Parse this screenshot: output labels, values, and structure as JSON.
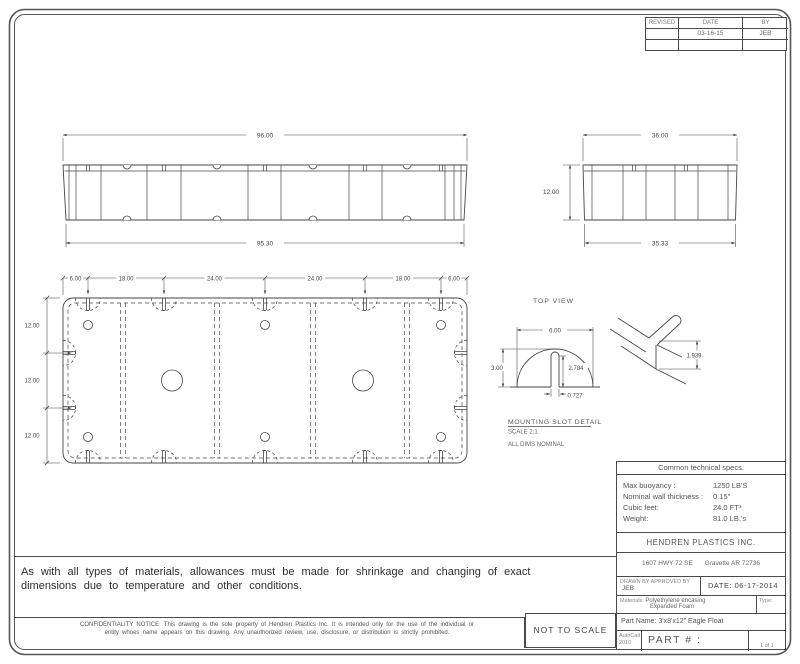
{
  "revision_table": {
    "headers": [
      "REVISED",
      "DATE",
      "BY"
    ],
    "rows": [
      [
        "",
        "03-16-15",
        "JEB"
      ],
      [
        "",
        "",
        ""
      ]
    ]
  },
  "front_view": {
    "dim_top": "96.00",
    "dim_bottom": "95.30"
  },
  "end_view": {
    "dim_top": "36.00",
    "dim_bottom": "35.33",
    "dim_height": "12.00"
  },
  "plan_view": {
    "label": "TOP VIEW",
    "dims_top": [
      "6.00",
      "18.00",
      "24.00",
      "24.00",
      "18.00",
      "6.00"
    ],
    "dims_left": [
      "12.00",
      "12.00",
      "12.00"
    ]
  },
  "slot_detail": {
    "title": "MOUNTING SLOT DETAIL",
    "scale": "SCALE 2:1",
    "note": "ALL DIMS NOMINAL",
    "dim_width": "6.00",
    "dim_height": "3.00",
    "dim_slot_depth": "2.784",
    "dim_slot_width": "0.727"
  },
  "iso_detail": {
    "dim": "1.939"
  },
  "specs": {
    "title": "Common technical specs.",
    "rows": [
      {
        "label": "Max buoyancy :",
        "value": "1250 LB'S"
      },
      {
        "label": "Nominal wall thickness :",
        "value": "0.15\""
      },
      {
        "label": "Cubic feet:",
        "value": "24.0 FT³"
      },
      {
        "label": "Weight:",
        "value": "81.0 LB.'s"
      }
    ]
  },
  "company": {
    "name": "HENDREN PLASTICS INC.",
    "address1": "1607 HWY 72 SE",
    "address2": "Gravette AR 72736"
  },
  "title_block": {
    "drawn_by_label": "DRAWN BY",
    "approved_by_label": "APPROVED BY",
    "initials": "JEB",
    "date_label": "DATE:",
    "date": "06-17-2014",
    "materials_label": "Materials:",
    "materials_1": "Polyethylene encasing",
    "materials_2": "Expanded Foam",
    "type_label": "Type:",
    "part_name_label": "Part Name:",
    "part_name": "3'x8'x12\" Eagle Float",
    "software_1": "AutoCad",
    "software_2": "2010",
    "part_number": "PART # : EF3812",
    "sheet": "1 of 1"
  },
  "notes": {
    "disclaimer_1": "As with all types of materials, allowances must be made for shrinkage and changing of exact",
    "disclaimer_2": "dimensions due to temperature and other conditions.",
    "confidentiality_1": "CONFIDENTIALITY NOTICE: This drawing is the sole property of Hendren Plastics Inc. It is intended only for the use of the individual or",
    "confidentiality_2": "entity whoes name appears on this drawing. Any unauthorized review, use, disclosure, or distribution is strictly prohibited.",
    "not_to_scale": "NOT TO SCALE"
  }
}
